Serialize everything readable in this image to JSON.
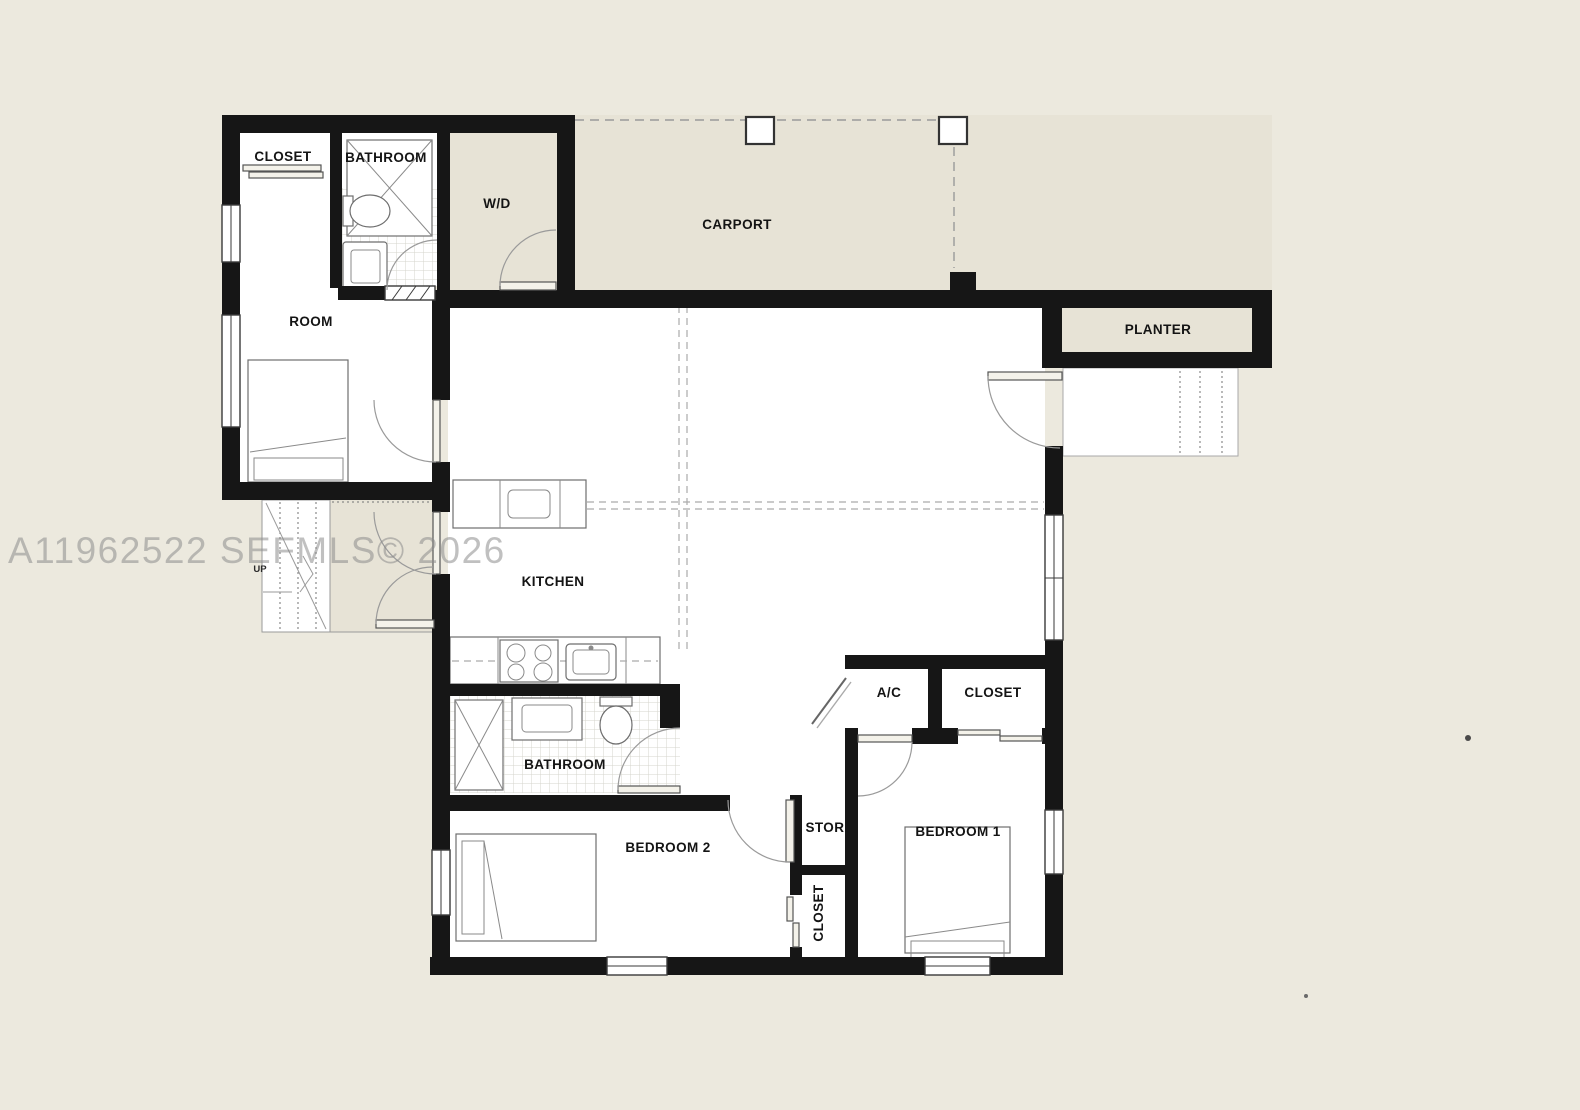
{
  "watermark": "A11962522 SEFMLS© 2026",
  "labels": {
    "closet_top": "CLOSET",
    "bathroom_top": "BATHROOM",
    "wd": "W/D",
    "carport": "CARPORT",
    "planter": "PLANTER",
    "room": "ROOM",
    "kitchen": "KITCHEN",
    "ac": "A/C",
    "closet_hall": "CLOSET",
    "bathroom_main": "BATHROOM",
    "bedroom2": "BEDROOM 2",
    "stor": "STOR.",
    "closet_bedroom2": "CLOSET",
    "bedroom1": "BEDROOM 1",
    "up": "UP"
  },
  "colors": {
    "wall": "#161616",
    "page_background": "#ece9de",
    "exterior_floor": "#e7e3d6",
    "interior_floor": "#ffffff",
    "line_gray": "#9a9a9a",
    "watermark_gray": "#8d8d8d"
  }
}
